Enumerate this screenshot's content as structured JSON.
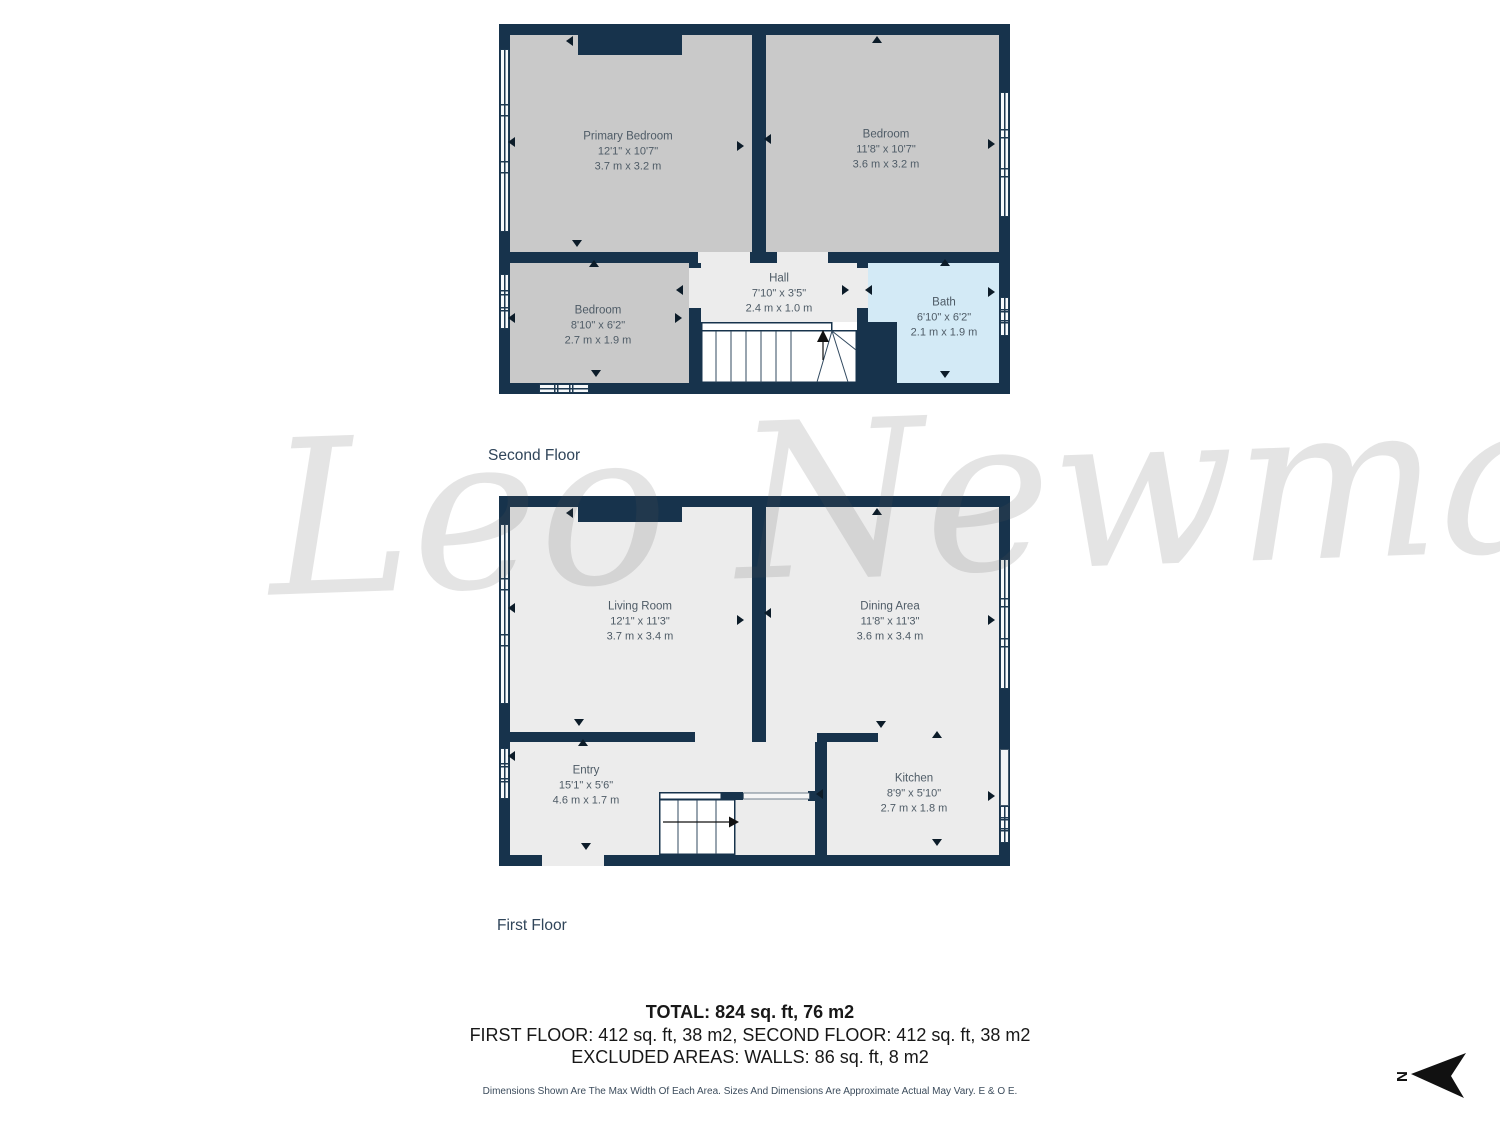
{
  "watermark": "Leo Newma",
  "floors": [
    {
      "title": "Second Floor",
      "rooms": [
        {
          "name": "Primary Bedroom",
          "imperial": "12'1\" x 10'7\"",
          "metric": "3.7 m x 3.2 m"
        },
        {
          "name": "Bedroom",
          "imperial": "11'8\" x 10'7\"",
          "metric": "3.6 m x 3.2 m"
        },
        {
          "name": "Bedroom",
          "imperial": "8'10\" x 6'2\"",
          "metric": "2.7 m x 1.9 m"
        },
        {
          "name": "Hall",
          "imperial": "7'10\" x 3'5\"",
          "metric": "2.4 m x 1.0 m"
        },
        {
          "name": "Bath",
          "imperial": "6'10\" x 6'2\"",
          "metric": "2.1 m x 1.9 m"
        }
      ]
    },
    {
      "title": "First Floor",
      "rooms": [
        {
          "name": "Living Room",
          "imperial": "12'1\" x 11'3\"",
          "metric": "3.7 m x 3.4 m"
        },
        {
          "name": "Dining Area",
          "imperial": "11'8\" x 11'3\"",
          "metric": "3.6 m x 3.4 m"
        },
        {
          "name": "Entry",
          "imperial": "15'1\" x 5'6\"",
          "metric": "4.6 m x 1.7 m"
        },
        {
          "name": "Kitchen",
          "imperial": "8'9\" x 5'10\"",
          "metric": "2.7 m x 1.8 m"
        }
      ]
    }
  ],
  "summary": {
    "total": "TOTAL: 824 sq. ft, 76 m2",
    "floors_line": "FIRST FLOOR: 412 sq. ft, 38 m2, SECOND FLOOR: 412 sq. ft, 38 m2",
    "excluded": "EXCLUDED AREAS: WALLS: 86 sq. ft, 8 m2",
    "disclaimer": "Dimensions Shown Are The Max Width Of Each Area. Sizes And Dimensions Are Approximate Actual May Vary. E & O E."
  },
  "compass": {
    "label": "N"
  },
  "colors": {
    "wall": "#17334c",
    "bedroom_floor": "#c9c9c9",
    "floor_light": "#ececec",
    "bath_floor": "#d3eaf6",
    "stairs": "#ffffff",
    "label_text": "#4e5b66"
  }
}
